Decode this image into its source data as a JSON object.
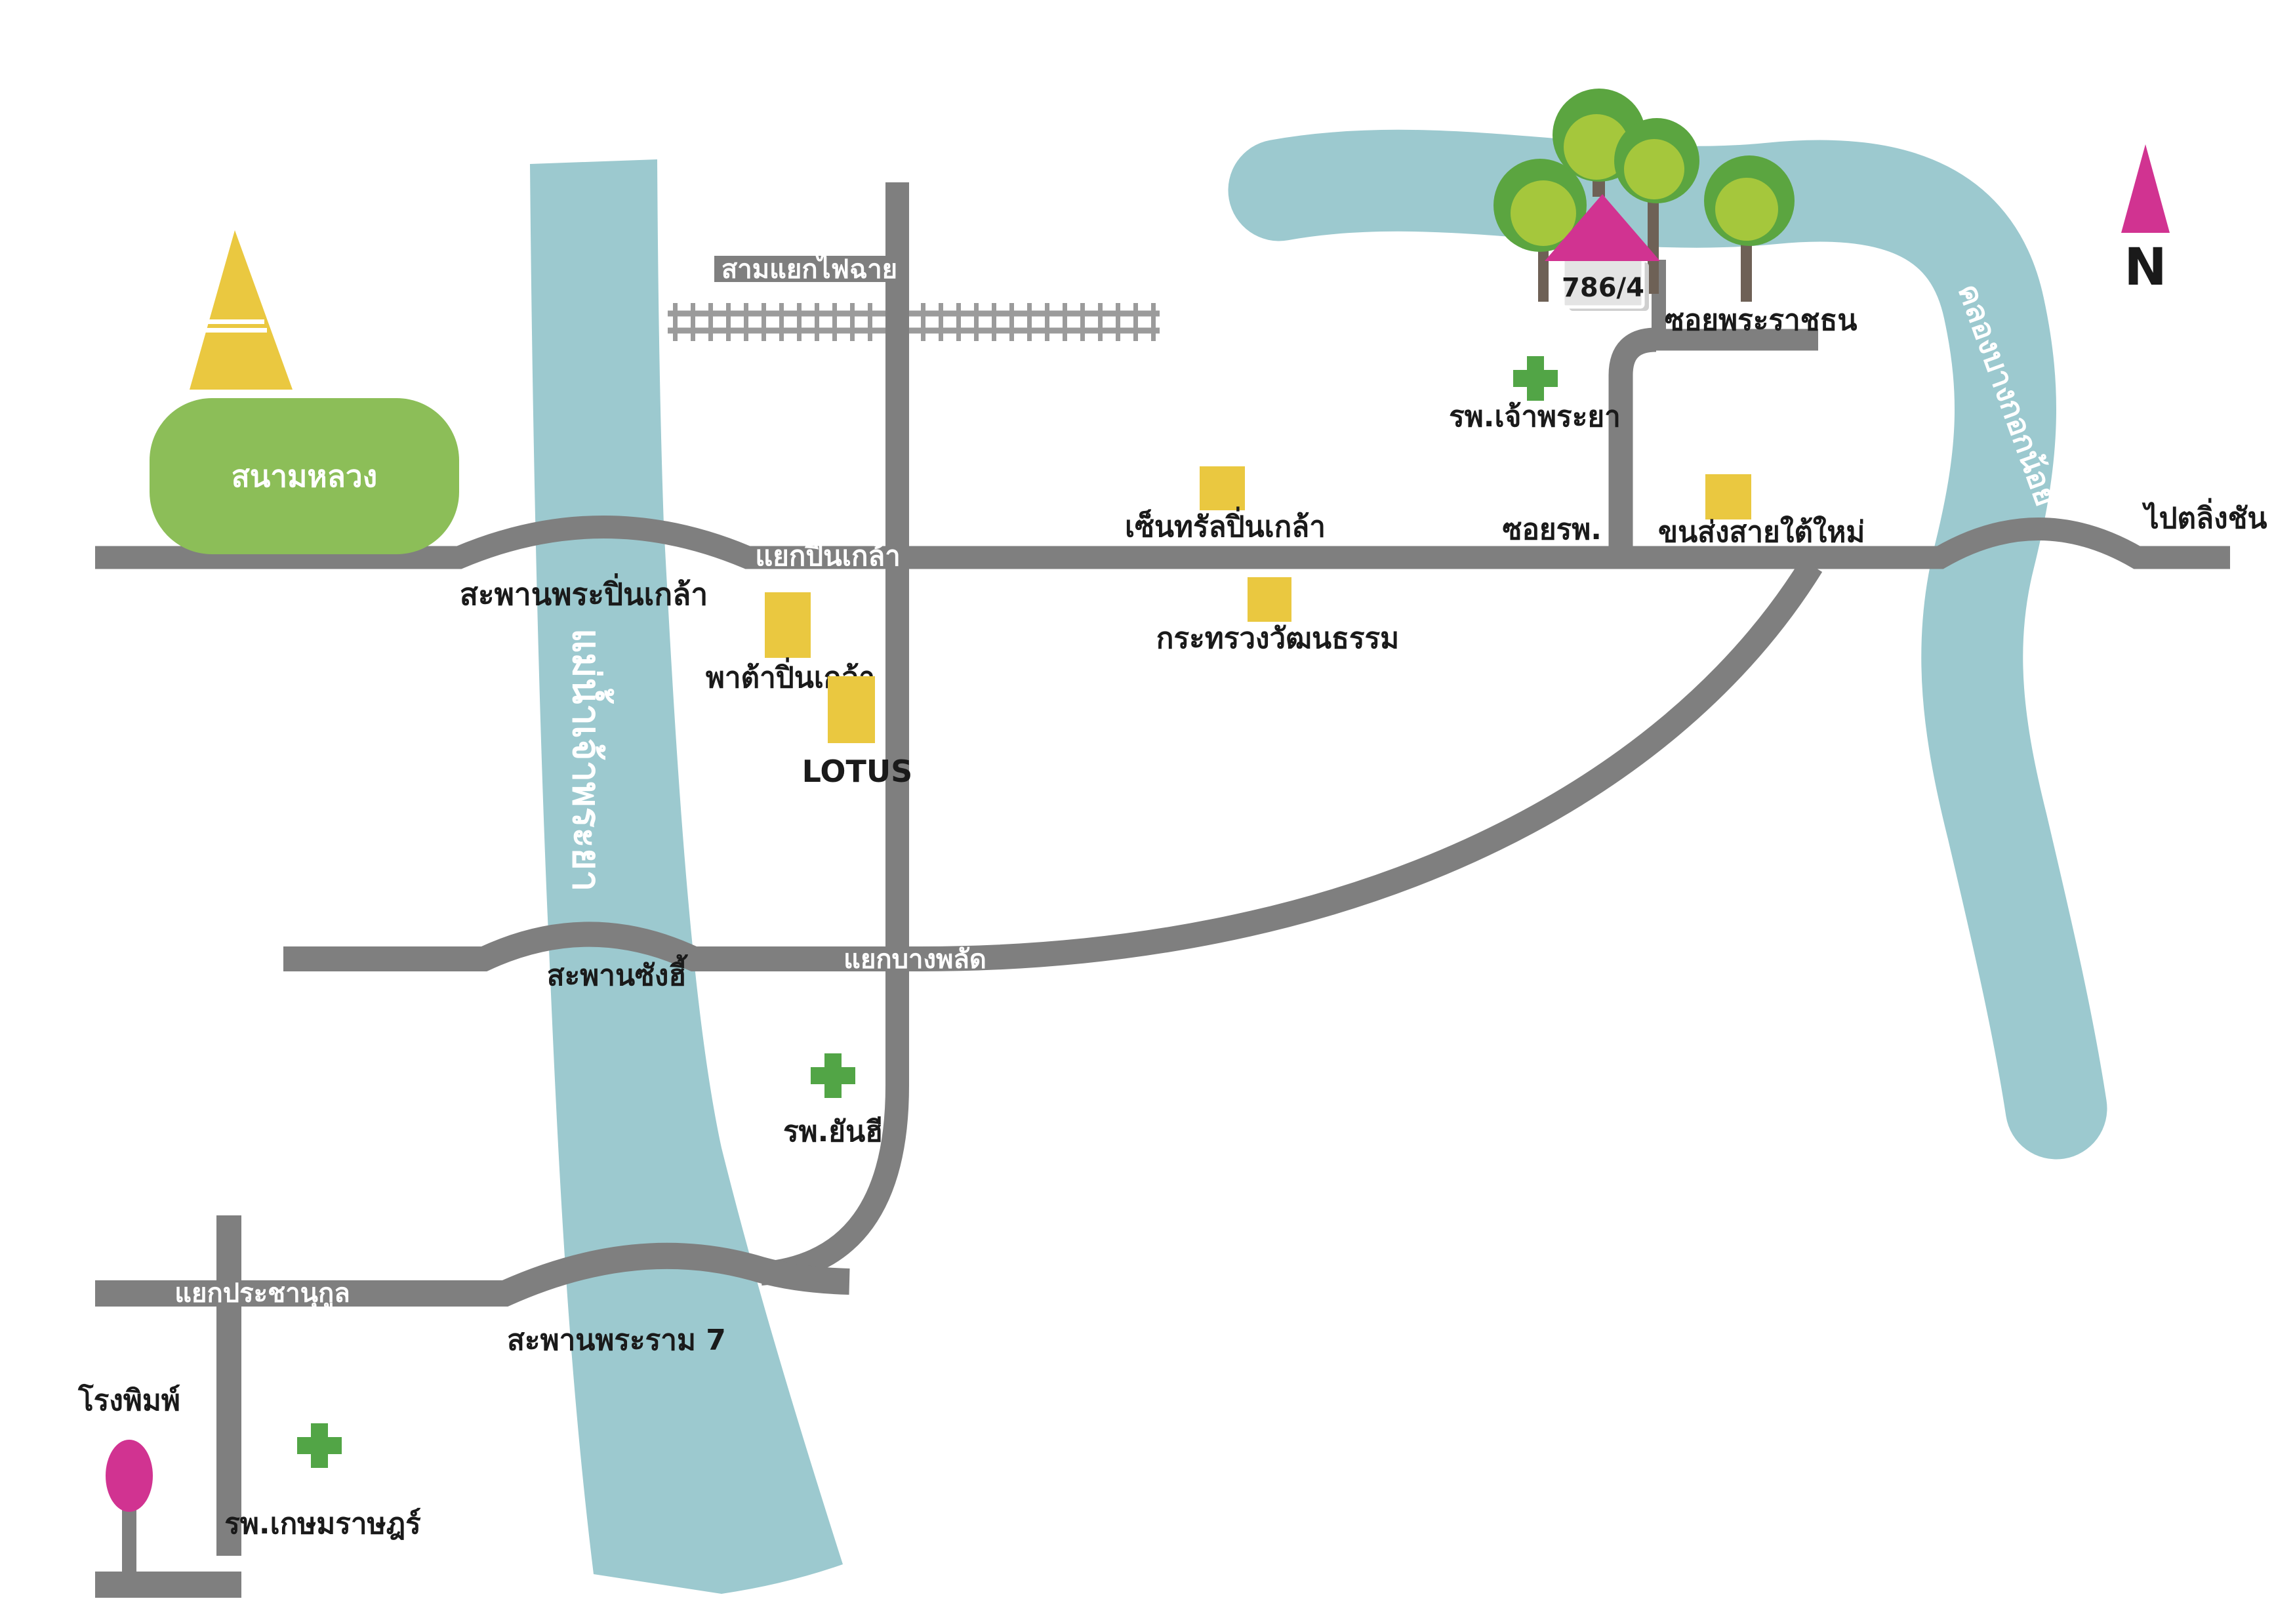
{
  "colors": {
    "background": "#FFFFFF",
    "river": "#9CC9CF",
    "road": "#7F7F7F",
    "railway": "#9B9B9B",
    "landmark_yellow": "#EAC840",
    "field_green": "#8CBE58",
    "tree_green_outer": "#5BA540",
    "tree_green_inner": "#A5C73C",
    "hospital_green": "#52A546",
    "accent_magenta": "#D13391",
    "tree_trunk_brown": "#6E6156",
    "house_gray": "#E4E4E4",
    "house_shadow": "#CFCFCF",
    "label_dark": "#1A1A1A",
    "label_light": "#FFFFFF"
  },
  "compass": {
    "north_label": "N"
  },
  "destination": {
    "house_number": "786/4"
  },
  "waterways": {
    "chao_phraya_river": "แม่น้ำเจ้าพระยา",
    "bangkok_noi_canal": "คลองบางกอกน้อย"
  },
  "roads": {
    "fai_chai_junction": "สามแยกไฟฉาย",
    "pinklao_junction": "แยกปิ่นเกล้า",
    "phra_pinklao_bridge": "สะพานพระปิ่นเกล้า",
    "bang_phlat_junction": "แยกบางพลัด",
    "sang_hi_bridge": "สะพานซังฮี้",
    "pracha_nukun_junction": "แยกประชานุกูล",
    "rama_7_bridge": "สะพานพระราม 7",
    "hospital_soi": "ซอยรพ.",
    "phra_ratchathon_soi": "ซอยพระราชธน",
    "to_taling_chan": "ไปตลิ่งชัน"
  },
  "places": {
    "sanam_luang": "สนามหลวง",
    "pata_pinklao": "พาต้าปิ่นเกล้า",
    "lotus": "LOTUS",
    "central_pinklao": "เซ็นทรัลปิ่นเกล้า",
    "ministry_of_culture": "กระทรวงวัฒนธรรม",
    "chao_phraya_hospital": "รพ.เจ้าพระยา",
    "new_southern_bus_terminal": "ขนส่งสายใต้ใหม่",
    "yanhee_hospital": "รพ.ยันฮี",
    "printing_house": "โรงพิมพ์",
    "kasemrad_hospital": "รพ.เกษมราษฎร์"
  }
}
